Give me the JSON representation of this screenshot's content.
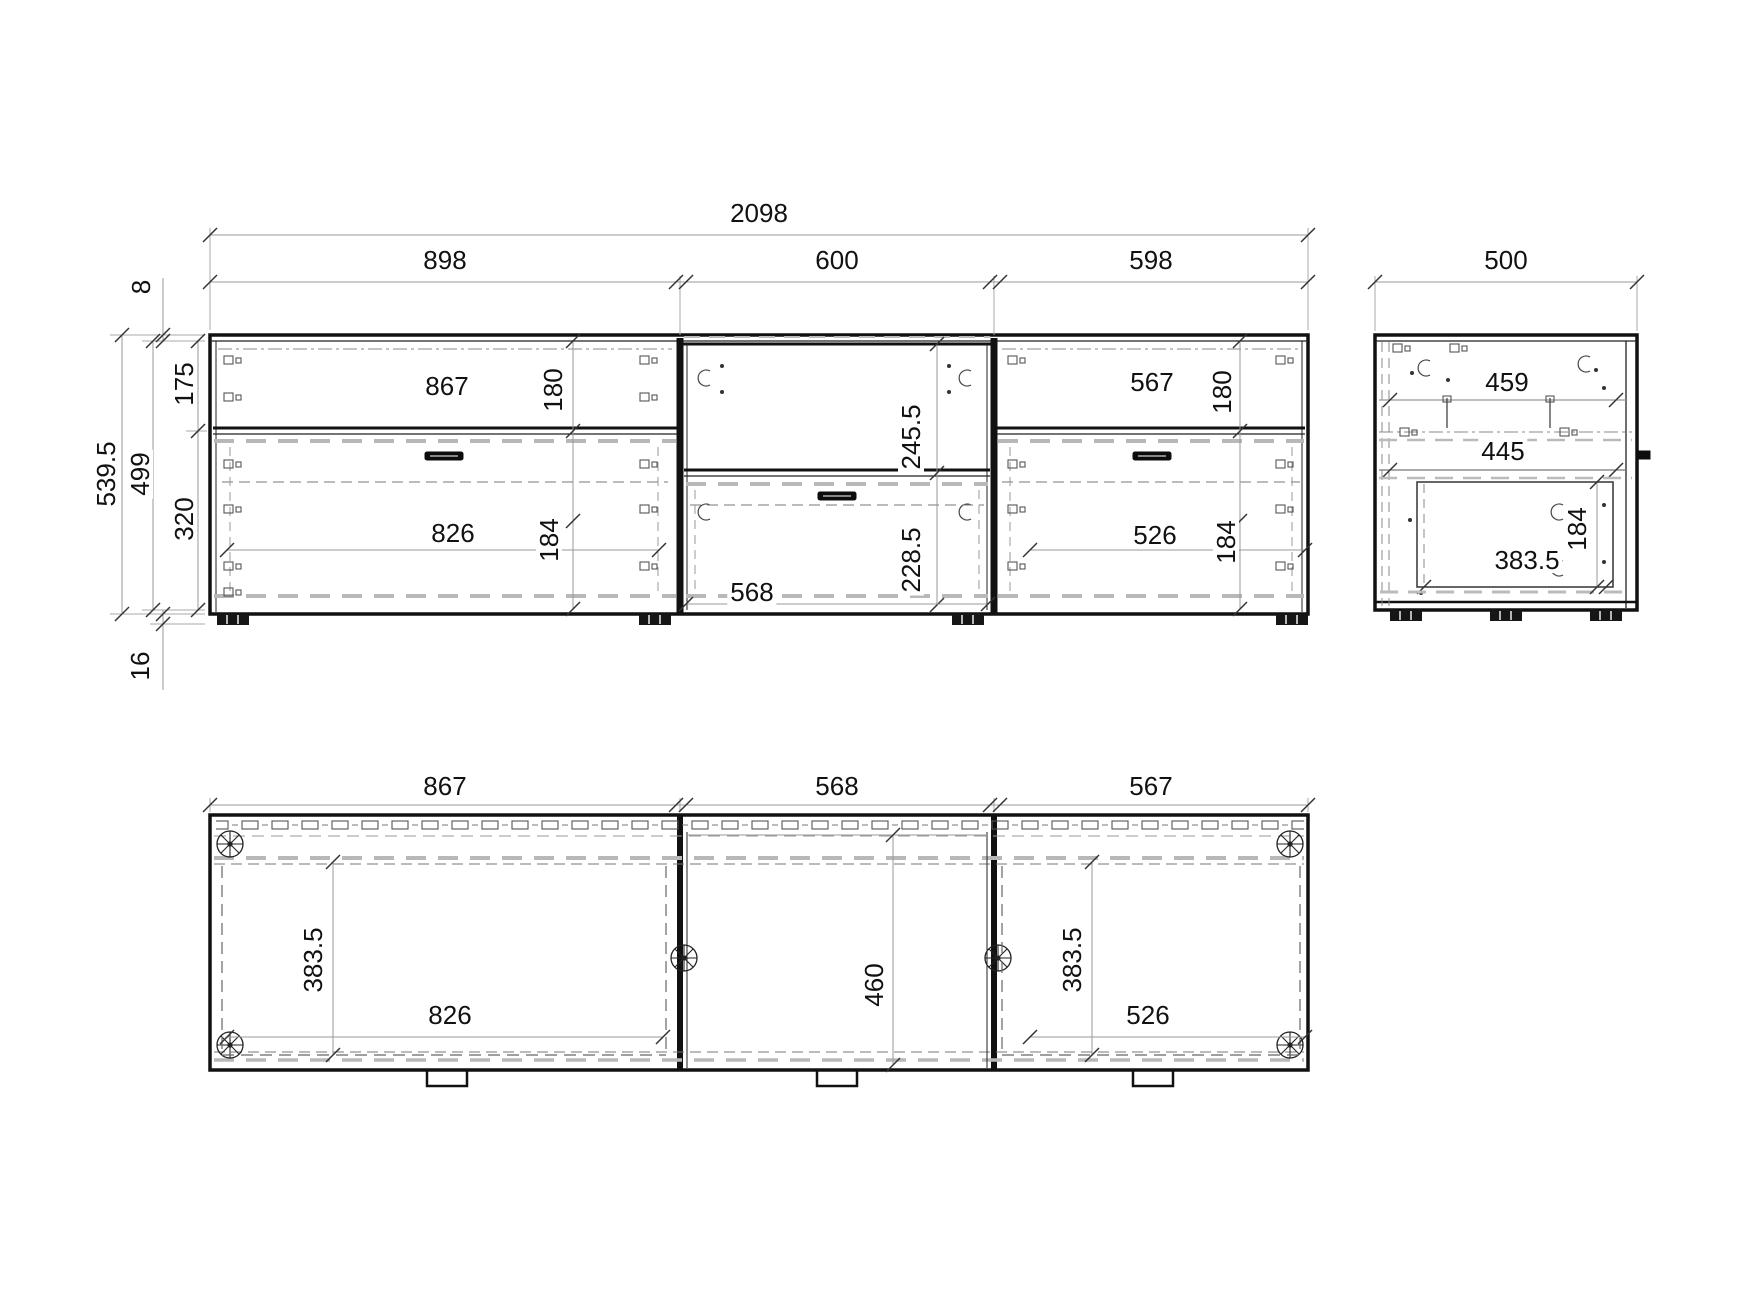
{
  "drawing": {
    "front_view": {
      "overall_width": "2098",
      "section_widths": {
        "left": "898",
        "middle": "600",
        "right": "598"
      },
      "height_chain": {
        "top_thickness": "8",
        "overall_height": "539.5",
        "carcass_height": "499",
        "upper_opening": "175",
        "lower_opening": "320",
        "foot_height": "16"
      },
      "left_section": {
        "opening_width": "867",
        "flap_height": "180",
        "drawer_width": "826",
        "drawer_height": "184"
      },
      "middle_section": {
        "opening_height": "245.5",
        "drawer_opening_height": "228.5",
        "drawer_width": "568"
      },
      "right_section": {
        "opening_width": "567",
        "flap_height": "180",
        "drawer_width": "526",
        "drawer_height": "184"
      }
    },
    "side_view": {
      "overall_depth": "500",
      "top_inner_depth": "459",
      "shelf_depth": "445",
      "drawer_depth": "383.5",
      "drawer_height": "184"
    },
    "plan_view": {
      "left_opening": "867",
      "middle_opening": "568",
      "right_opening": "567",
      "left_door_depth": "383.5",
      "left_drawer_width": "826",
      "middle_inner_depth": "460",
      "right_door_depth": "383.5",
      "right_drawer_width": "526"
    }
  }
}
